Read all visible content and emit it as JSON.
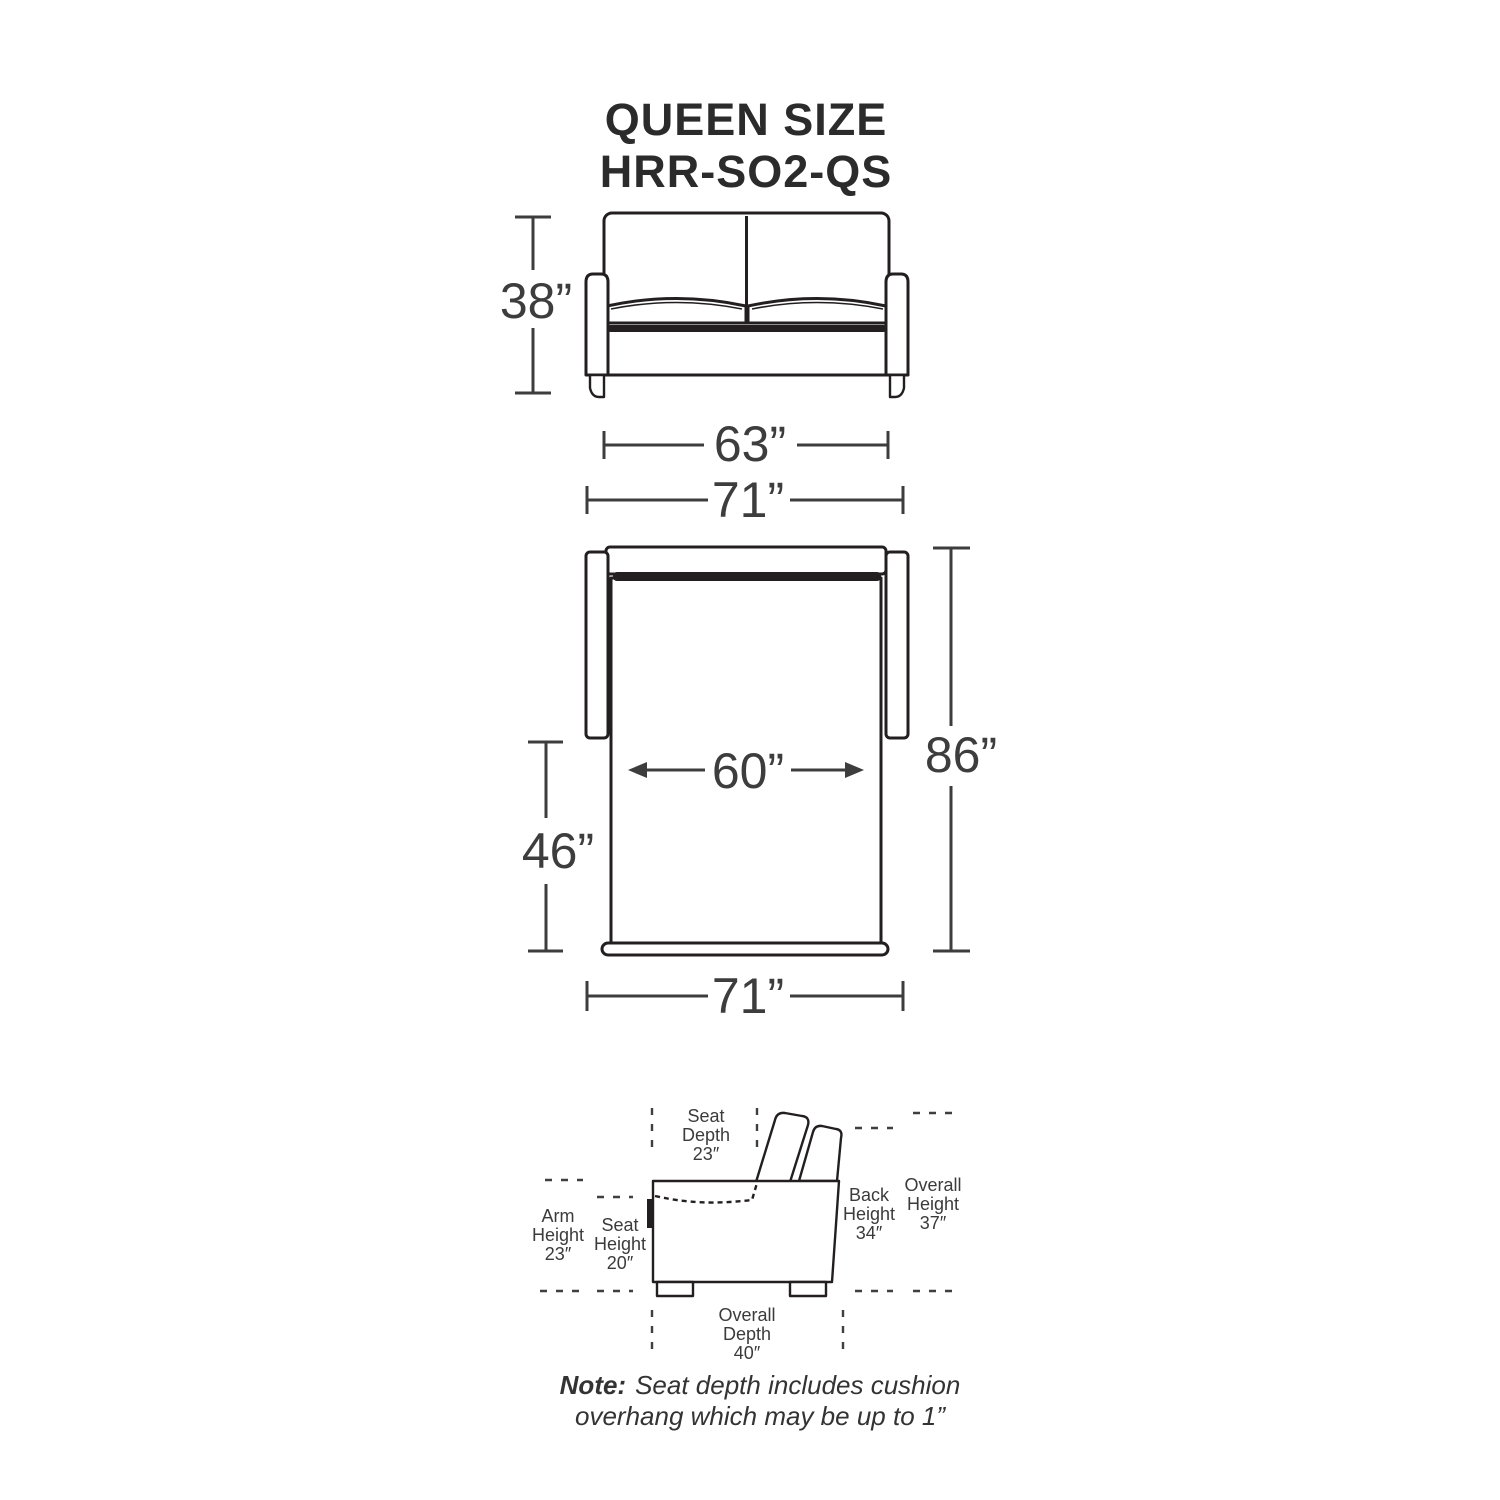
{
  "title": {
    "line1": "QUEEN SIZE",
    "line2": "HRR-SO2-QS"
  },
  "dimensions": {
    "front_height": "38”",
    "front_width": "63”",
    "top_overall_width": "71”",
    "mattress_width": "60”",
    "bed_extension": "46”",
    "overall_open_depth": "86”",
    "bottom_overall_width": "71”"
  },
  "side_view_labels": {
    "seat_depth": [
      "Seat",
      "Depth",
      "23″"
    ],
    "arm_height": [
      "Arm",
      "Height",
      "23″"
    ],
    "seat_height": [
      "Seat",
      "Height",
      "20″"
    ],
    "back_height": [
      "Back",
      "Height",
      "34″"
    ],
    "overall_height": [
      "Overall",
      "Height",
      "37″"
    ],
    "overall_depth": [
      "Overall",
      "Depth",
      "40″"
    ]
  },
  "note": {
    "prefix": "Note:",
    "line1": "Seat depth includes cushion",
    "line2": "overhang which may be up to 1”"
  },
  "colors": {
    "outline": "#231f20",
    "dimension": "#3d3d3d",
    "background": "#ffffff"
  }
}
